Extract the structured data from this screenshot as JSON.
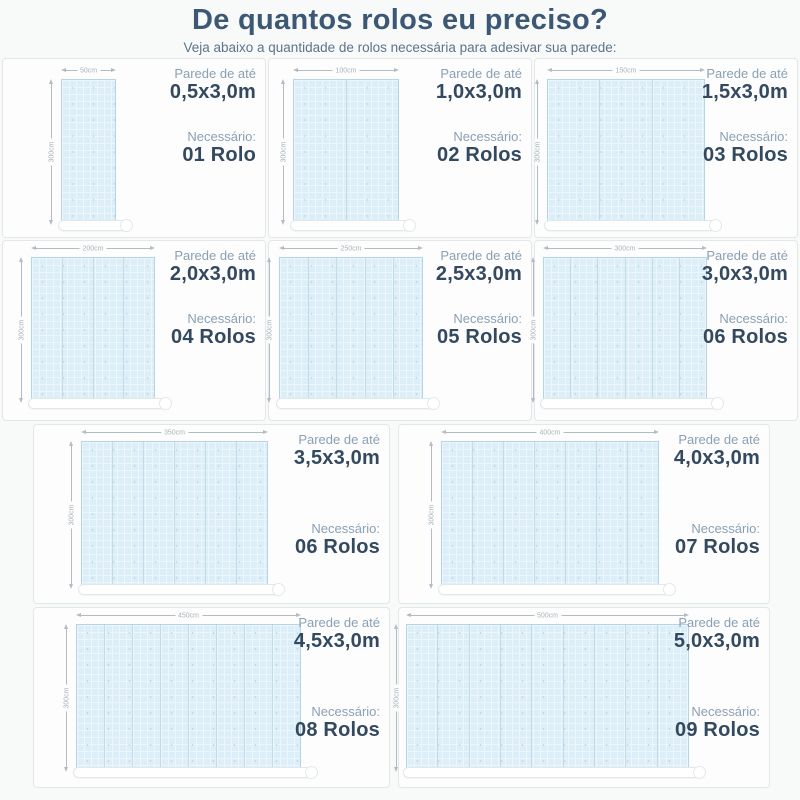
{
  "header": {
    "title": "De quantos rolos eu preciso?",
    "subtitle": "Veja abaixo a quantidade de rolos necessária para adesivar sua parede:"
  },
  "labels": {
    "wall_prefix": "Parede de até",
    "needed": "Necessário:"
  },
  "panels": [
    {
      "size": "0,5x3,0m",
      "rolls_label": "01 Rolo",
      "rolls": 1,
      "width_label": "50cm",
      "height_label": "300cm"
    },
    {
      "size": "1,0x3,0m",
      "rolls_label": "02 Rolos",
      "rolls": 2,
      "width_label": "100cm",
      "height_label": "300cm"
    },
    {
      "size": "1,5x3,0m",
      "rolls_label": "03 Rolos",
      "rolls": 3,
      "width_label": "150cm",
      "height_label": "300cm"
    },
    {
      "size": "2,0x3,0m",
      "rolls_label": "04 Rolos",
      "rolls": 4,
      "width_label": "200cm",
      "height_label": "300cm"
    },
    {
      "size": "2,5x3,0m",
      "rolls_label": "05 Rolos",
      "rolls": 5,
      "width_label": "250cm",
      "height_label": "300cm"
    },
    {
      "size": "3,0x3,0m",
      "rolls_label": "06 Rolos",
      "rolls": 6,
      "width_label": "300cm",
      "height_label": "300cm"
    },
    {
      "size": "3,5x3,0m",
      "rolls_label": "06 Rolos",
      "rolls": 6,
      "width_label": "350cm",
      "height_label": "300cm"
    },
    {
      "size": "4,0x3,0m",
      "rolls_label": "07 Rolos",
      "rolls": 7,
      "width_label": "400cm",
      "height_label": "300cm"
    },
    {
      "size": "4,5x3,0m",
      "rolls_label": "08 Rolos",
      "rolls": 8,
      "width_label": "450cm",
      "height_label": "300cm"
    },
    {
      "size": "5,0x3,0m",
      "rolls_label": "09 Rolos",
      "rolls": 9,
      "width_label": "500cm",
      "height_label": "300cm"
    }
  ],
  "colors": {
    "title": "#3d5875",
    "subtitle": "#5d7489",
    "label": "#8aa0b4",
    "value": "#32495f",
    "wallfill": "#dceef8",
    "wallborder": "#b7d4e4",
    "panelbg": "#fdfdfd",
    "pagebg": "#f8f9f9"
  }
}
